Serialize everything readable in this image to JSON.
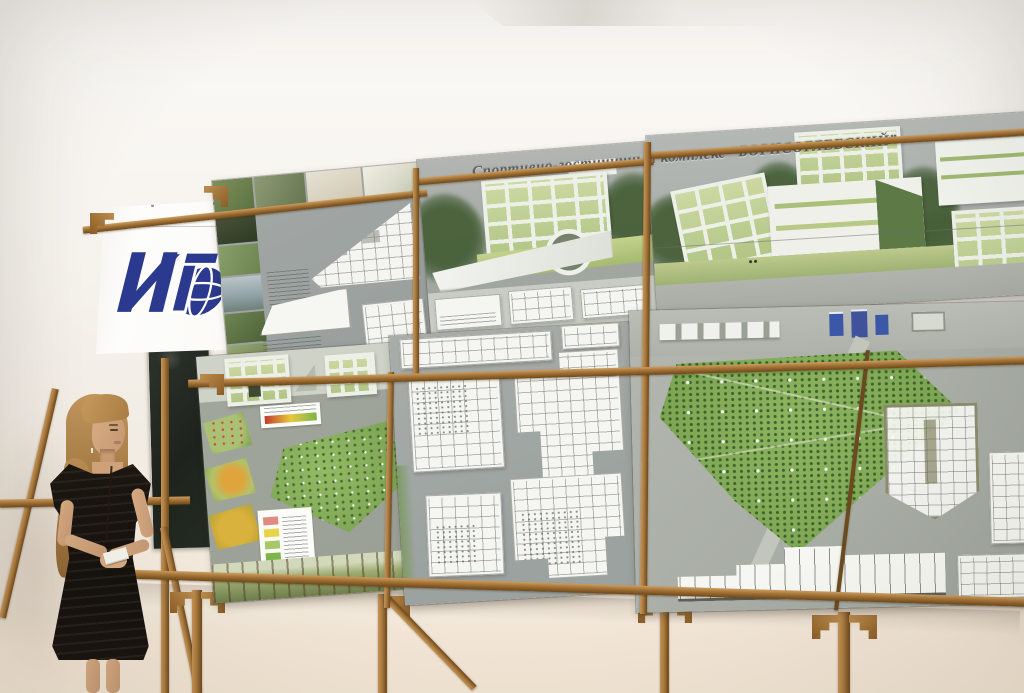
{
  "exhibit": {
    "project_title": "Спортивно-гостиничный комплекс “БОРИСОГЛЕБСКИЙ”"
  },
  "icons": {
    "logo": "institute-globe-logo"
  },
  "palette": {
    "wall": "#f5f2ec",
    "wall_lower": "#f2e7d6",
    "wood": "#a87a3e",
    "board_sky_gray": "#a8ada9",
    "site_green": "#86b15c",
    "glass_green": "#c3d398",
    "accent_blue_buildings": "#3c57a8",
    "logo_blue": "#2b3a8e",
    "chalkboard_green": "#242b23",
    "banner_white": "#fcfcfa",
    "dress_black": "#17130f",
    "hair_blonde": "#b5884e",
    "skin": "#d0a47c"
  }
}
